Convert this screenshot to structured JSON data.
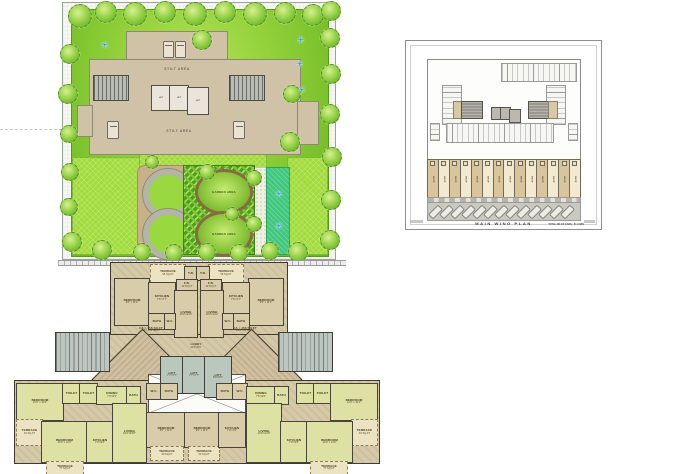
{
  "site_plan": {
    "stilt_area_label": "STILT AREA",
    "garden_area_label": "GARDEN AREA",
    "lift_label": "LIFT",
    "colors": {
      "lawn_green": "#93d23b",
      "lime_green": "#a2dc3c",
      "building_tan": "#cfc2a6",
      "flower_blue": "#1f9ad6"
    }
  },
  "parking_plan": {
    "title": "MAIN WING PLAN",
    "note": "TOTAL NO OF CARS : 51 CARS",
    "shop_label": "SHOP",
    "shops_count": 14
  },
  "floor_plan": {
    "colors": {
      "unit_olive": "#dde1a4",
      "unit_tan": "#d9cca9",
      "terrace": "#ebe3c2",
      "core_gray": "#b9c7bc"
    },
    "rooms": [
      {
        "x": 150,
        "y": 264,
        "w": 34,
        "h": 17,
        "c": "terrace",
        "l": "TERRACE",
        "s": "95 SQ.FT"
      },
      {
        "x": 208,
        "y": 264,
        "w": 34,
        "h": 17,
        "c": "terrace",
        "l": "TERRACE",
        "s": "95 SQ.FT"
      },
      {
        "x": 184,
        "y": 266,
        "w": 12,
        "h": 13,
        "c": "tan",
        "l": "T.B.",
        "s": ""
      },
      {
        "x": 196,
        "y": 266,
        "w": 12,
        "h": 13,
        "c": "tan",
        "l": "T.B.",
        "s": ""
      },
      {
        "x": 114,
        "y": 278,
        "w": 34,
        "h": 46,
        "c": "tan",
        "l": "BEDROOM",
        "s": "9'6\" x 11'0\""
      },
      {
        "x": 248,
        "y": 278,
        "w": 34,
        "h": 46,
        "c": "tan",
        "l": "BEDROOM",
        "s": "9'6\" x 11'0\""
      },
      {
        "x": 148,
        "y": 282,
        "w": 26,
        "h": 31,
        "c": "tan",
        "l": "KITCHEN",
        "s": "7'6\"x7'7\""
      },
      {
        "x": 222,
        "y": 282,
        "w": 26,
        "h": 31,
        "c": "tan",
        "l": "KITCHEN",
        "s": "7'6\"x7'7\""
      },
      {
        "x": 176,
        "y": 279,
        "w": 20,
        "h": 11,
        "c": "tan",
        "l": "F.B.",
        "s": "30 SQ.FT"
      },
      {
        "x": 200,
        "y": 279,
        "w": 20,
        "h": 11,
        "c": "tan",
        "l": "F.B.",
        "s": "30 SQ.FT"
      },
      {
        "x": 174,
        "y": 290,
        "w": 22,
        "h": 46,
        "c": "tan",
        "l": "LIVING",
        "s": "10'0\"x14'3\""
      },
      {
        "x": 200,
        "y": 290,
        "w": 22,
        "h": 46,
        "c": "tan",
        "l": "LIVING",
        "s": "10'0\"x14'3\""
      },
      {
        "x": 148,
        "y": 313,
        "w": 16,
        "h": 15,
        "c": "tan",
        "l": "BATH",
        "s": ""
      },
      {
        "x": 164,
        "y": 313,
        "w": 10,
        "h": 15,
        "c": "tan",
        "l": "W.C.",
        "s": ""
      },
      {
        "x": 232,
        "y": 313,
        "w": 16,
        "h": 15,
        "c": "tan",
        "l": "BATH",
        "s": ""
      },
      {
        "x": 222,
        "y": 313,
        "w": 10,
        "h": 15,
        "c": "tan",
        "l": "W.C.",
        "s": ""
      },
      {
        "x": 128,
        "y": 325,
        "w": 46,
        "h": 10,
        "c": "note",
        "l": "CA = 456 SQ.FT",
        "s": "CA = 700 SQ.FT"
      },
      {
        "x": 222,
        "y": 325,
        "w": 46,
        "h": 10,
        "c": "note",
        "l": "CA = 456 SQ.FT",
        "s": "CA = 700 SQ.FT"
      },
      {
        "x": 176,
        "y": 340,
        "w": 40,
        "h": 13,
        "c": "note",
        "l": "LOBBY",
        "s": "21'0\"x8'3\""
      },
      {
        "x": 160,
        "y": 356,
        "w": 22,
        "h": 36,
        "c": "lift",
        "l": "LIFT",
        "s": "7'7\"x7'7\""
      },
      {
        "x": 182,
        "y": 356,
        "w": 22,
        "h": 36,
        "c": "lift",
        "l": "LIFT",
        "s": "7'7\"x7'7\""
      },
      {
        "x": 204,
        "y": 356,
        "w": 26,
        "h": 40,
        "c": "lift",
        "l": "LIFT",
        "s": "8'0\"x6'0\""
      },
      {
        "x": 55,
        "y": 332,
        "w": 53,
        "h": 38,
        "c": "stair",
        "l": "",
        "s": ""
      },
      {
        "x": 278,
        "y": 332,
        "w": 53,
        "h": 38,
        "c": "stair",
        "l": "",
        "s": ""
      },
      {
        "x": 16,
        "y": 383,
        "w": 46,
        "h": 36,
        "c": "olive",
        "l": "BEDROOM",
        "s": "12'0\" x 10'0\""
      },
      {
        "x": 16,
        "y": 419,
        "w": 25,
        "h": 25,
        "c": "terrace",
        "l": "TERRACE",
        "s": "40 SQ.FT"
      },
      {
        "x": 41,
        "y": 421,
        "w": 45,
        "h": 40,
        "c": "olive",
        "l": "BEDROOM",
        "s": "10'0\" x 11'0\""
      },
      {
        "x": 46,
        "y": 461,
        "w": 36,
        "h": 12,
        "c": "terrace",
        "l": "TERRACE",
        "s": "77 SQ.FT"
      },
      {
        "x": 62,
        "y": 383,
        "w": 17,
        "h": 19,
        "c": "olive",
        "l": "TOILET",
        "s": ""
      },
      {
        "x": 79,
        "y": 383,
        "w": 17,
        "h": 19,
        "c": "olive",
        "l": "TOILET",
        "s": ""
      },
      {
        "x": 96,
        "y": 386,
        "w": 30,
        "h": 17,
        "c": "olive",
        "l": "DINING",
        "s": "7'0\"x9'0\""
      },
      {
        "x": 126,
        "y": 386,
        "w": 13,
        "h": 17,
        "c": "olive",
        "l": "BATH",
        "s": ""
      },
      {
        "x": 86,
        "y": 421,
        "w": 26,
        "h": 40,
        "c": "olive",
        "l": "KITCHEN",
        "s": "7'0\"x9'6\""
      },
      {
        "x": 112,
        "y": 403,
        "w": 33,
        "h": 58,
        "c": "olive",
        "l": "LIVING",
        "s": "10'0\"x15'6\""
      },
      {
        "x": 146,
        "y": 383,
        "w": 14,
        "h": 15,
        "c": "tan",
        "l": "W.C.",
        "s": ""
      },
      {
        "x": 160,
        "y": 383,
        "w": 16,
        "h": 15,
        "c": "tan",
        "l": "BATH",
        "s": ""
      },
      {
        "x": 146,
        "y": 412,
        "w": 38,
        "h": 34,
        "c": "tan",
        "l": "BEDROOM",
        "s": "9'0\" x 11'0\""
      },
      {
        "x": 150,
        "y": 446,
        "w": 32,
        "h": 13,
        "c": "terrace",
        "l": "TERRACE",
        "s": "30 SQ.FT"
      },
      {
        "x": 184,
        "y": 412,
        "w": 34,
        "h": 34,
        "c": "tan",
        "l": "BEDROOM",
        "s": "9'0\" x 11'0\""
      },
      {
        "x": 188,
        "y": 446,
        "w": 30,
        "h": 13,
        "c": "terrace",
        "l": "TERRACE",
        "s": "30 SQ.FT"
      },
      {
        "x": 218,
        "y": 412,
        "w": 26,
        "h": 34,
        "c": "tan",
        "l": "KITCHEN",
        "s": "7'0\"x7'0\""
      },
      {
        "x": 216,
        "y": 383,
        "w": 16,
        "h": 15,
        "c": "tan",
        "l": "BATH",
        "s": ""
      },
      {
        "x": 232,
        "y": 383,
        "w": 14,
        "h": 15,
        "c": "tan",
        "l": "W.C.",
        "s": ""
      },
      {
        "x": 246,
        "y": 386,
        "w": 28,
        "h": 17,
        "c": "olive",
        "l": "DINING",
        "s": "7'6\"x9'0\""
      },
      {
        "x": 274,
        "y": 386,
        "w": 13,
        "h": 17,
        "c": "olive",
        "l": "BATH",
        "s": ""
      },
      {
        "x": 246,
        "y": 403,
        "w": 34,
        "h": 58,
        "c": "olive",
        "l": "LIVING",
        "s": "10'0\"x14'0\""
      },
      {
        "x": 280,
        "y": 421,
        "w": 26,
        "h": 40,
        "c": "olive",
        "l": "KITCHEN",
        "s": "7'0\"x9'6\""
      },
      {
        "x": 296,
        "y": 383,
        "w": 17,
        "h": 19,
        "c": "olive",
        "l": "TOILET",
        "s": ""
      },
      {
        "x": 313,
        "y": 383,
        "w": 17,
        "h": 19,
        "c": "olive",
        "l": "TOILET",
        "s": ""
      },
      {
        "x": 330,
        "y": 383,
        "w": 46,
        "h": 36,
        "c": "olive",
        "l": "BEDROOM",
        "s": "12'0\" x 10'0\""
      },
      {
        "x": 351,
        "y": 419,
        "w": 25,
        "h": 25,
        "c": "terrace",
        "l": "TERRACE",
        "s": "40 SQ.FT"
      },
      {
        "x": 306,
        "y": 421,
        "w": 45,
        "h": 40,
        "c": "olive",
        "l": "BEDROOM",
        "s": "10'0\" x 11'0\""
      },
      {
        "x": 310,
        "y": 461,
        "w": 36,
        "h": 12,
        "c": "terrace",
        "l": "TERRACE",
        "s": "77 SQ.FT"
      }
    ]
  }
}
